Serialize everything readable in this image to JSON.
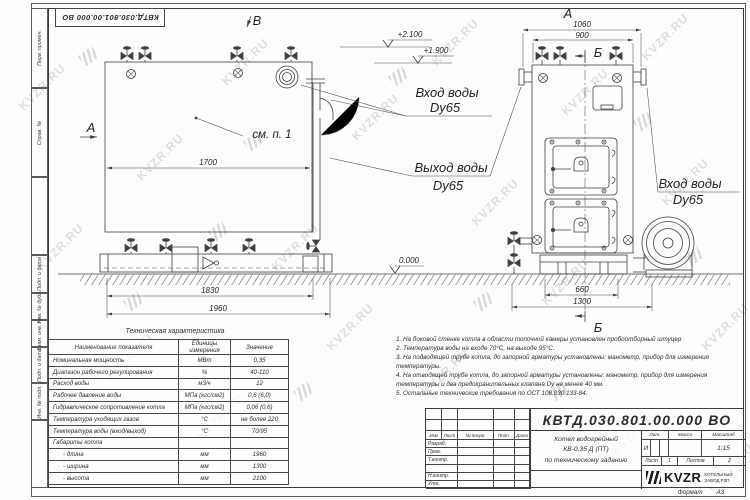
{
  "page": {
    "watermark": "KVZR.RU",
    "doc_number": "КВТД.030.801.00.000 ВО",
    "format_label": "Формат",
    "format_value": "А3"
  },
  "margin_labels": [
    "Перв. примен.",
    "Справ. №",
    "Подп. и дата",
    "Инв. № дубл.",
    "Взам. инв. №",
    "Подп. и дата",
    "Инв. № подл."
  ],
  "drawing": {
    "view_b": "В",
    "section_a": "А",
    "view_a": "А",
    "section_b_top": "Б",
    "section_b_bottom": "Б",
    "callout": "см. п. 1",
    "water_in": "Вход воды",
    "water_out": "Выход воды",
    "dn65": "Dy65",
    "level_2100": "+2.100",
    "level_1900": "+1.900",
    "level_0": "0.000",
    "dim_1700": "1700",
    "dim_1830": "1830",
    "dim_1960": "1960",
    "dim_1060": "1060",
    "dim_900": "900",
    "dim_660": "660",
    "dim_1300": "1300"
  },
  "spec_table": {
    "title": "Техническая характеристика",
    "headers": [
      "Наименование показателя",
      "Единицы измерения",
      "Значение"
    ],
    "rows": [
      [
        "Номинальная мощность",
        "МВт",
        "0,35"
      ],
      [
        "Диапазон рабочего регулирования",
        "%",
        "40-110"
      ],
      [
        "Расход воды",
        "м3/ч",
        "12"
      ],
      [
        "Рабочее давление воды",
        "МПа (кгс/см2)",
        "0,6 (6,0)"
      ],
      [
        "Гидравлическое сопротивление котла",
        "МПа (кгс/см2)",
        "0,06 (0,6)"
      ],
      [
        "Температура уходящих газов",
        "°С",
        "не более 220"
      ],
      [
        "Температура воды (вход/выход)",
        "°С",
        "70/95"
      ],
      [
        "Габариты котла",
        "",
        ""
      ],
      [
        "- длина",
        "мм",
        "1960"
      ],
      [
        "- ширина",
        "мм",
        "1300"
      ],
      [
        "- высота",
        "мм",
        "2100"
      ]
    ]
  },
  "notes": [
    "1.  На боковой стенке котла в области топочной камеры установлен пробоотборный штуцер",
    "2.  Температура воды на входе 70°С, на выходе 95°С.",
    "3.  На подводящей трубе котла, до запорной арматуры установлены: манометр, прибор для измерения температуры.",
    "4.  На отводящей трубе котла, до запорной арматуры установлены: манометр, прибор для измерения температуры и два предохранительных клапана Dу не менее 40 мм.",
    "5.  Остальные технические требования по ОСТ 108.030.133-84."
  ],
  "title_block": {
    "doc_number": "КВТД.030.801.00.000 ВО",
    "cols": [
      "Изм",
      "Лист",
      "№ докум.",
      "Подп.",
      "Дата"
    ],
    "rows": [
      "Разраб.",
      "Пров.",
      "Т.контр.",
      "",
      "Н.контр.",
      "Утв."
    ],
    "product_line1": "Котел водогрейный",
    "product_line2": "КВ-0,35 Д (ПТ)",
    "product_line3": "по техническому заданию",
    "lit_label": "Лит.",
    "lit_value": "И",
    "mass_label": "Масса",
    "mass_value": "",
    "scale_label": "Масштаб",
    "scale_value": "1:15",
    "sheet_label": "Лист",
    "sheet_value": "1",
    "sheets_label": "Листов",
    "sheets_value": "2",
    "brand": "KVZR",
    "company_line1": "КОТЕЛЬНЫЙ",
    "company_line2": "ЗАВОД РЗП"
  }
}
